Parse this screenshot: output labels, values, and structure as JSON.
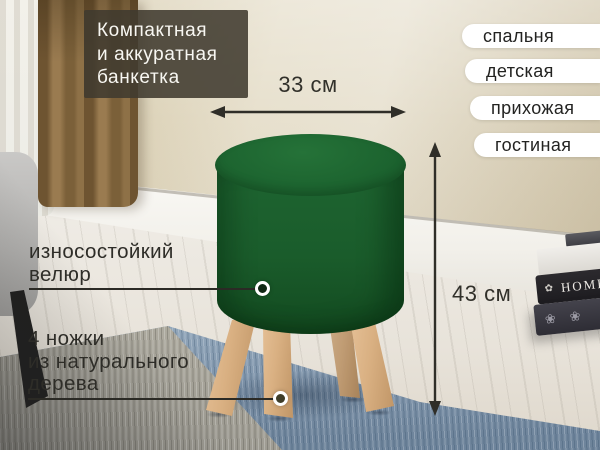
{
  "badge": {
    "line1": "Компактная",
    "line2": "и аккуратная",
    "line3": "банкетка"
  },
  "rooms": {
    "items": [
      {
        "label": "спальня"
      },
      {
        "label": "детская"
      },
      {
        "label": "прихожая"
      },
      {
        "label": "гостиная"
      }
    ]
  },
  "dimensions": {
    "width": "33 см",
    "height": "43 см"
  },
  "callouts": {
    "velour": {
      "line1": "износостойкий",
      "line2": "велюр"
    },
    "legs": {
      "line1": "4 ножки",
      "line2": "из натурального",
      "line3": "дерева"
    }
  },
  "scene": {
    "book_spine": "HOME",
    "book_ornament": "✿",
    "flower": "❀"
  },
  "colors": {
    "ottoman_green": "#1c5e2d",
    "leg_wood": "#d7ae80",
    "rug_blue": "#8196ac",
    "badge_bg": "rgba(64,58,47,0.88)",
    "tag_bg": "#ffffff",
    "ink": "#2e2d28"
  }
}
